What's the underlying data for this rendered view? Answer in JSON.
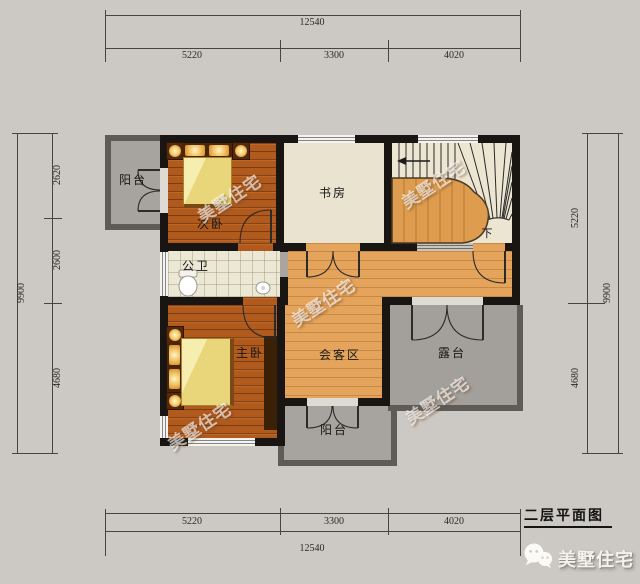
{
  "title_block": {
    "title": "二层平面图",
    "brand": "美墅住宅"
  },
  "watermark": {
    "text": "美墅住宅"
  },
  "rooms": {
    "balcony_top": "阳台",
    "bedroom2": "次卧",
    "study": "书房",
    "bathroom": "公卫",
    "master": "主卧",
    "living": "会客区",
    "terrace": "露台",
    "balcony_bottom": "阳台",
    "stairs_down": "下"
  },
  "dimensions": {
    "top": {
      "total": "12540",
      "segments": [
        "5220",
        "3300",
        "4020"
      ]
    },
    "bottom": {
      "total": "12540",
      "segments": [
        "5220",
        "3300",
        "4020"
      ]
    },
    "left": {
      "total": "9900",
      "segments": [
        "2620",
        "2600",
        "4680"
      ]
    },
    "right": {
      "total": "9900",
      "segments": [
        "5220",
        "4680"
      ]
    }
  },
  "colors": {
    "background": "#ccc8c3",
    "wall": "#181512",
    "wood_dark": "#b05a1d",
    "wood_light": "#e5a45c",
    "study_floor": "#eae3d0",
    "tile": "#ece8d6",
    "outdoor_gray": "#a7a49f",
    "parapet": "#5f5c57",
    "quilt_yellow": "#e9d67b",
    "watermark_white": "#ffffff"
  }
}
